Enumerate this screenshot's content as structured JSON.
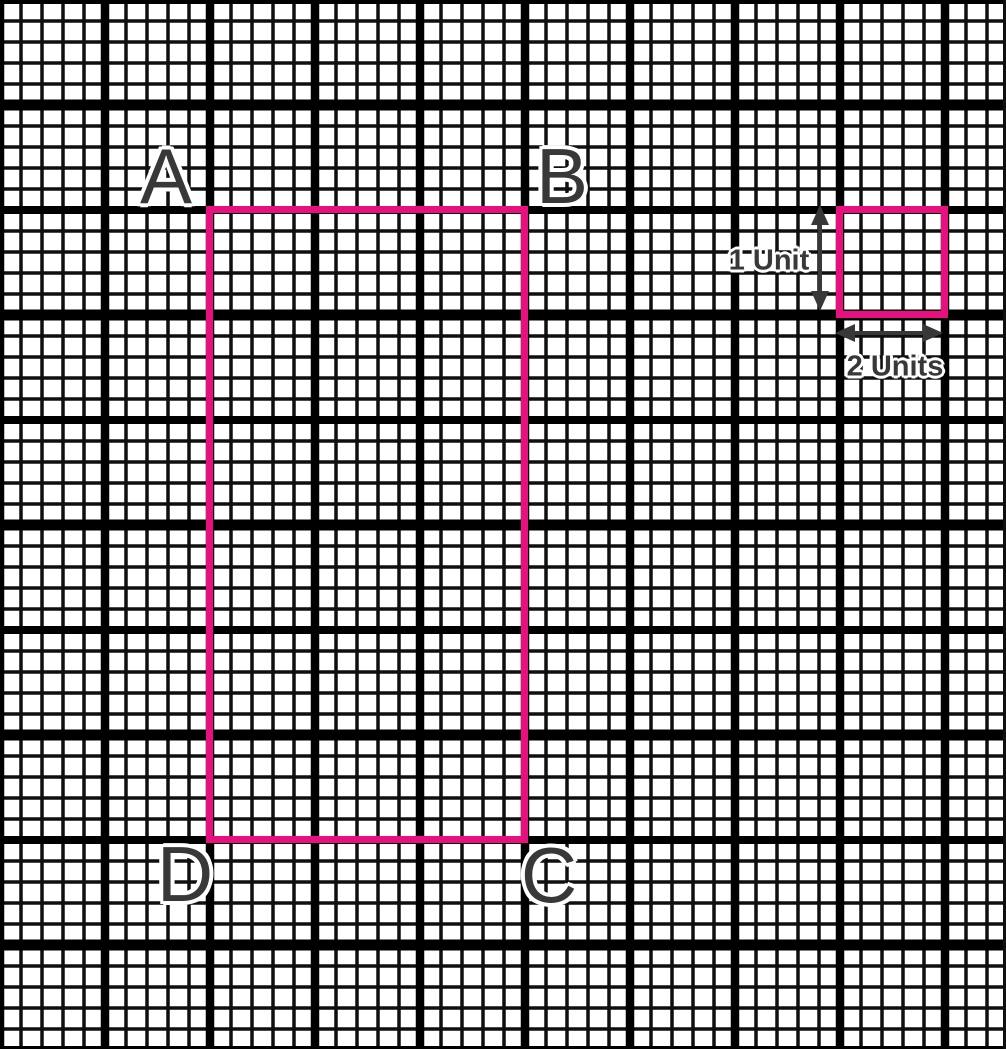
{
  "colors": {
    "shape_pink": "#E8107E",
    "label_gray": "#383838",
    "grid_line": "#0f0f0f",
    "grid_major": "#000000",
    "paper": "#ffffff"
  },
  "diagram": {
    "type": "geometry-figure-on-grid-paper",
    "corner_labels": {
      "a": "A",
      "b": "B",
      "c": "C",
      "d": "D"
    },
    "unit_key": {
      "vertical_label": "1 Unit",
      "horizontal_label": "2 Units"
    },
    "icons": {
      "vertical_arrow": "double-headed-vertical-arrow",
      "horizontal_arrow": "double-headed-horizontal-arrow"
    }
  }
}
